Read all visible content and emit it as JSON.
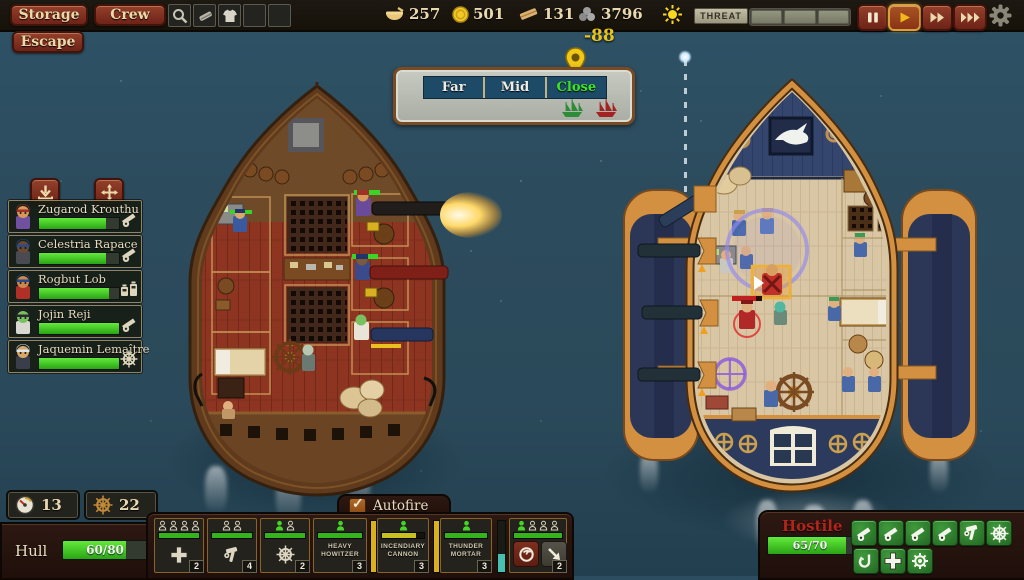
{
  "top_bar": {
    "storage_label": "Storage",
    "crew_label": "Crew",
    "quick_slots": [
      {
        "icon": "spyglass-icon"
      },
      {
        "icon": "whetstone-icon"
      },
      {
        "icon": "shirt-icon"
      },
      {
        "icon": "empty"
      },
      {
        "icon": "empty"
      }
    ],
    "resources": [
      {
        "id": "food",
        "icon": "bowl-icon",
        "value": "257"
      },
      {
        "id": "gold",
        "icon": "coin-icon",
        "value": "501"
      },
      {
        "id": "planks",
        "icon": "plank-icon",
        "value": "131"
      },
      {
        "id": "cannonballs",
        "icon": "cannonballs-icon",
        "value": "3796"
      }
    ],
    "weather_icon": "sun-icon",
    "threat": {
      "label": "THREAT",
      "segments": 3,
      "filled": 0
    },
    "time_controls": [
      {
        "id": "pause",
        "icon": "pause-icon",
        "active": false
      },
      {
        "id": "play",
        "icon": "play-icon",
        "active": true
      },
      {
        "id": "fast-forward",
        "icon": "fast-forward-icon",
        "active": false
      },
      {
        "id": "fastest-forward",
        "icon": "fastest-forward-icon",
        "active": false
      }
    ],
    "settings_icon": "gear-icon"
  },
  "escape_button": {
    "label": "Escape"
  },
  "range_panel": {
    "distance_value": "-88",
    "options": [
      {
        "label": "Far",
        "active": false
      },
      {
        "label": "Mid",
        "active": false
      },
      {
        "label": "Close",
        "active": true
      }
    ],
    "player_ship_icon": "green-ship-icon",
    "enemy_ship_icon": "red-ship-icon"
  },
  "crew_panel": {
    "buttons": [
      {
        "icon": "download-icon"
      },
      {
        "icon": "move-icon"
      }
    ],
    "members": [
      {
        "name": "Zugarod Krouthu",
        "health_pct": 84,
        "role_icon": "cannon-icon",
        "portrait": {
          "hat": "#a03028",
          "skin": "#d89858",
          "body": "#7050a0"
        }
      },
      {
        "name": "Celestria Rapace",
        "health_pct": 84,
        "role_icon": "cannon-icon",
        "portrait": {
          "hat": "#2a4a8a",
          "skin": "#6a4a32",
          "body": "#4a4a52"
        }
      },
      {
        "name": "Rogbut Lob",
        "health_pct": 88,
        "role_icon": "machines-icon",
        "portrait": {
          "hat": "#2a4a8a",
          "skin": "#c88850",
          "body": "#b03028"
        }
      },
      {
        "name": "Jojin Reji",
        "health_pct": 100,
        "role_icon": "cannon-icon",
        "portrait": {
          "hat": "#2a2a2e",
          "skin": "#7ac060",
          "body": "#d8d8d0"
        }
      },
      {
        "name": "Jaquemin Lemaître",
        "health_pct": 100,
        "role_icon": "wheel-icon",
        "portrait": {
          "hat": "#dde4ea",
          "skin": "#d8a868",
          "body": "#3a3e4a"
        }
      }
    ]
  },
  "player_status": {
    "gauge_icon": "gauge-icon",
    "gauge_value": "13",
    "wheel_icon": "brown-wheel-icon",
    "wheel_value": "22",
    "hull_label": "Hull",
    "hull_value": "60/80",
    "hull_pct": 75
  },
  "weapons_bar": {
    "autofire": {
      "label": "Autofire",
      "checked": true
    },
    "slots": [
      {
        "id": "medic-station",
        "icon": "medic-plus-icon",
        "badge": "2",
        "crew": [
          0,
          0,
          0,
          0
        ],
        "bar_pct": 100,
        "bar_color": "#34b31c"
      },
      {
        "id": "repair-station",
        "icon": "repair-icon",
        "badge": "4",
        "crew": [
          0,
          0
        ],
        "bar_pct": 100,
        "bar_color": "#34b31c"
      },
      {
        "id": "helm-station",
        "icon": "helm-wheel-icon",
        "badge": "2",
        "crew": [
          1,
          0
        ],
        "bar_pct": 100,
        "bar_color": "#34b31c"
      },
      {
        "id": "heavy-howitzer",
        "label1": "HEAVY",
        "label2": "HOWITZER",
        "badge": "3",
        "crew": [
          1
        ],
        "bar_pct": 100,
        "bar_color": "#34b31c"
      },
      {
        "id": "incendiary-cannon",
        "label1": "INCENDIARY",
        "label2": "CANNON",
        "badge": "3",
        "crew": [
          1
        ],
        "bar_pct": 82,
        "bar_color": "#c6c020"
      },
      {
        "id": "thunder-mortar",
        "label1": "THUNDER",
        "label2": "MORTAR",
        "badge": "3",
        "crew": [
          1
        ],
        "bar_pct": 100,
        "bar_color": "#34b31c"
      }
    ],
    "side_gauges": [
      {
        "pct": 100,
        "color": "#d8b020"
      },
      {
        "pct": 100,
        "color": "#d8b020"
      }
    ],
    "boarding_gauge": {
      "pct": 35,
      "color": "#48c0b0"
    },
    "boarding_slot": {
      "badge": "2",
      "crew": [
        1,
        0,
        0,
        0
      ],
      "bar_pct": 100,
      "bar_color": "#34b31c",
      "defend_icon": "defend-swirl-icon",
      "attack_icon": "attack-arrow-icon"
    }
  },
  "hostile_panel": {
    "title": "Hostile",
    "health_value": "65/70",
    "health_pct": 93,
    "action_buttons_row1": [
      {
        "icon": "cannon-icon"
      },
      {
        "icon": "cannon-icon"
      },
      {
        "icon": "cannon-icon"
      },
      {
        "icon": "cannon-icon"
      },
      {
        "icon": "repair-icon"
      },
      {
        "icon": "helm-wheel-icon"
      }
    ],
    "action_buttons_row2": [
      {
        "icon": "hook-icon"
      },
      {
        "icon": "medic-plus-icon"
      },
      {
        "icon": "engine-icon"
      }
    ]
  }
}
